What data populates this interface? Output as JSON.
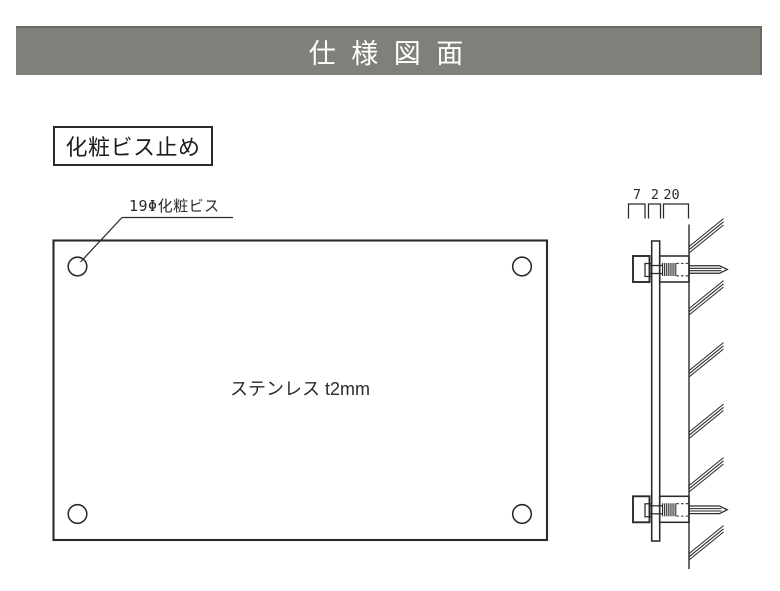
{
  "header": {
    "title": "仕 様 図 面"
  },
  "section": {
    "label": "化粧ビス止め"
  },
  "front_view": {
    "callout_label": "19Φ化粧ビス",
    "material_label": "ステンレス t2mm",
    "hole_count": 4
  },
  "side_view": {
    "dim_labels": [
      "7",
      "2",
      "20"
    ]
  },
  "colors": {
    "background": "#ffffff",
    "title_bar_bg": "#7d817a",
    "title_bar_edge": "#666a62",
    "title_text": "#ffffff",
    "line": "#2b2a27"
  }
}
